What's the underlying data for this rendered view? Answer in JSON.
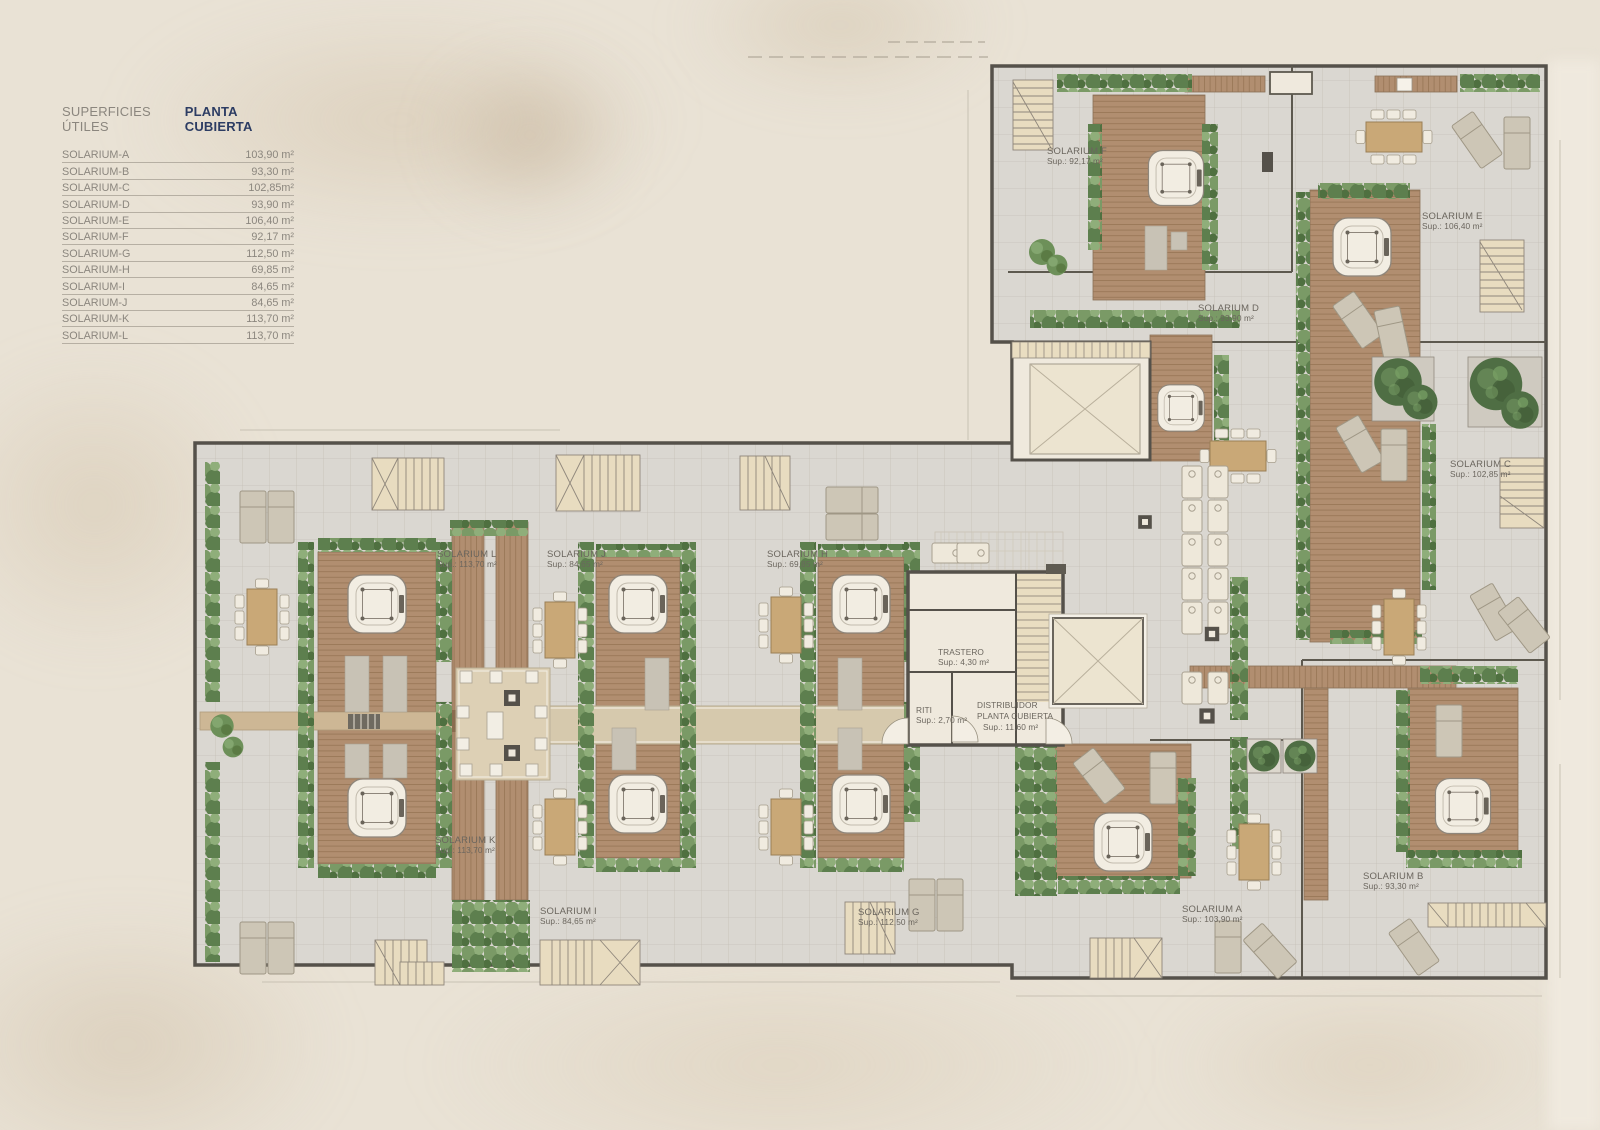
{
  "legend": {
    "title": "SUPERFICIES ÚTILES",
    "plan_name": "PLANTA CUBIERTA",
    "rows": [
      {
        "name": "SOLARIUM-A",
        "area": "103,90 m²"
      },
      {
        "name": "SOLARIUM-B",
        "area": "93,30 m²"
      },
      {
        "name": "SOLARIUM-C",
        "area": "102,85m²"
      },
      {
        "name": "SOLARIUM-D",
        "area": "93,90 m²"
      },
      {
        "name": "SOLARIUM-E",
        "area": "106,40 m²"
      },
      {
        "name": "SOLARIUM-F",
        "area": "92,17 m²"
      },
      {
        "name": "SOLARIUM-G",
        "area": "112,50 m²"
      },
      {
        "name": "SOLARIUM-H",
        "area": "69,85 m²"
      },
      {
        "name": "SOLARIUM-I",
        "area": "84,65 m²"
      },
      {
        "name": "SOLARIUM-J",
        "area": "84,65 m²"
      },
      {
        "name": "SOLARIUM-K",
        "area": "113,70 m²"
      },
      {
        "name": "SOLARIUM-L",
        "area": "113,70 m²"
      }
    ]
  },
  "plan": {
    "rooms": [
      {
        "name": "SOLARIUM F",
        "sup": "Sup.: 92,17 m²"
      },
      {
        "name": "SOLARIUM E",
        "sup": "Sup.: 106,40 m²"
      },
      {
        "name": "SOLARIUM D",
        "sup": "Sup.: 93,90 m²"
      },
      {
        "name": "SOLARIUM C",
        "sup": "Sup.: 102,85 m²"
      },
      {
        "name": "SOLARIUM L",
        "sup": "Sup.: 113,70 m²"
      },
      {
        "name": "SOLARIUM J",
        "sup": "Sup.: 84,65 m²"
      },
      {
        "name": "SOLARIUM H",
        "sup": "Sup.: 69,85 m²"
      },
      {
        "name": "SOLARIUM K",
        "sup": "Sup.: 113,70 m²"
      },
      {
        "name": "SOLARIUM I",
        "sup": "Sup.: 84,65 m²"
      },
      {
        "name": "SOLARIUM G",
        "sup": "Sup.: 112,50 m²"
      },
      {
        "name": "SOLARIUM A",
        "sup": "Sup.: 103,90 m²"
      },
      {
        "name": "SOLARIUM B",
        "sup": "Sup.: 93,30 m²"
      }
    ],
    "core": {
      "trastero": {
        "name": "TRASTERO",
        "sup": "Sup.: 4,30 m²"
      },
      "riti": {
        "name": "RITI",
        "sup": "Sup.: 2,70 m²"
      },
      "distribuidor": {
        "name": "DISTRIBUIDOR",
        "name2": "PLANTA CUBIERTA",
        "sup": "Sup.: 11,60 m²"
      }
    }
  },
  "colors": {
    "background": "#e9e2d5",
    "accent_navy": "#2c3c63",
    "wall": "#5d594f",
    "paving": "#dad7d1",
    "wood": "#b18e70",
    "plants": "#6d9059",
    "label_text": "#6b665e",
    "legend_text": "#8b867e"
  }
}
